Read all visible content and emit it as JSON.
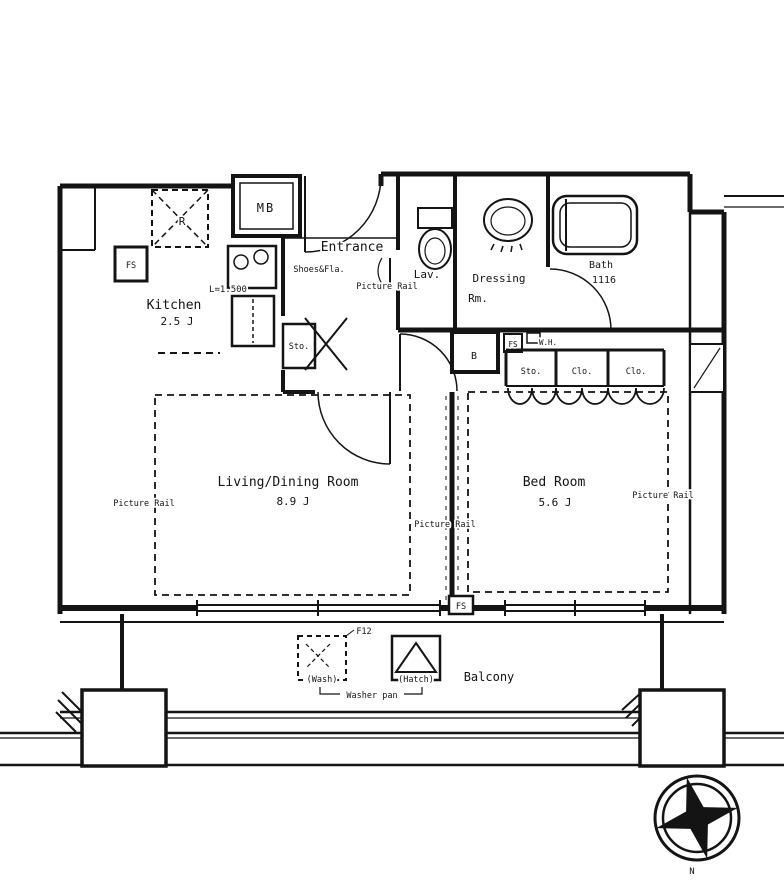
{
  "page": {
    "background": "#ffffff",
    "line_color": "#141414"
  },
  "rooms": {
    "kitchen": {
      "name": "Kitchen",
      "area": "2.5 J",
      "counter_length": "L=1.500"
    },
    "entrance": {
      "name": "Entrance",
      "shoes_label": "Shoes&Fla.",
      "picture_rail": "Picture Rail",
      "storage": "Sto."
    },
    "lavatory": {
      "name": "Lav."
    },
    "dressing_room": {
      "name_line1": "Dressing",
      "name_line2": "Rm."
    },
    "bathroom": {
      "name": "Bath",
      "size": "1116"
    },
    "living_dining": {
      "name": "Living/Dining Room",
      "area": "8.9 J"
    },
    "bedroom": {
      "name": "Bed Room",
      "area": "5.6 J"
    },
    "balcony": {
      "name": "Balcony"
    }
  },
  "fixtures": {
    "meter_box": "MB",
    "refrigerator": "R",
    "pipe_space_kitchen": "FS",
    "pipe_space_hall": "FS",
    "pipe_space_window": "FS",
    "water_heater": "W.H.",
    "duct": "B",
    "storage": "Sto.",
    "closets": [
      "Clo.",
      "Clo."
    ],
    "washer_space": "(Wash)",
    "hatch": "(Hatch)",
    "washer_pan": "Washer pan",
    "floor_drain": "F12"
  },
  "annotations": {
    "picture_rail_left": "Picture Rail",
    "picture_rail_middle": "Picture Rail",
    "picture_rail_right": "Picture Rail",
    "compass_north": "N"
  }
}
